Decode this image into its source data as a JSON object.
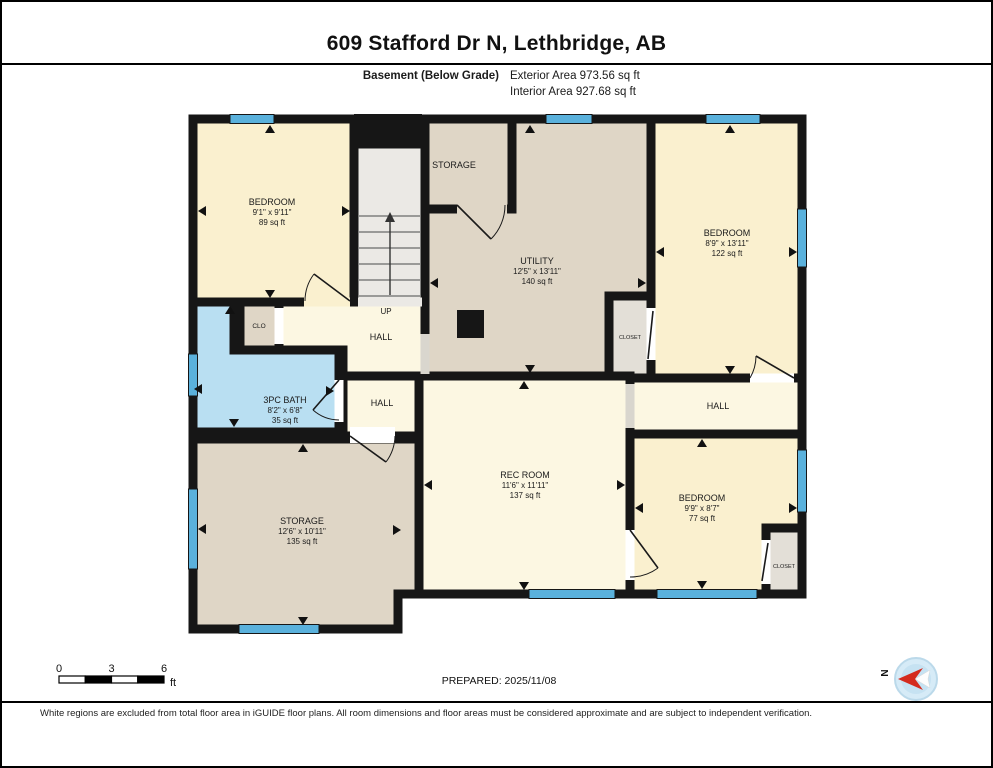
{
  "header": {
    "title": "609 Stafford Dr N, Lethbridge, AB",
    "floor_label": "Basement (Below Grade)",
    "exterior_area": "Exterior Area 973.56 sq ft",
    "interior_area": "Interior Area 927.68 sq ft"
  },
  "rooms": {
    "bedroom_top_left": {
      "name": "BEDROOM",
      "dims": "9'1\" x 9'11\"",
      "area": "89 sq ft"
    },
    "storage_top": {
      "name": "STORAGE"
    },
    "utility": {
      "name": "UTILITY",
      "dims": "12'5\" x 13'11\"",
      "area": "140 sq ft"
    },
    "bedroom_top_right": {
      "name": "BEDROOM",
      "dims": "8'9\" x 13'11\"",
      "area": "122 sq ft"
    },
    "closet_small": {
      "name": "CLO"
    },
    "stair_label": {
      "name": "UP"
    },
    "hall_center": {
      "name": "HALL"
    },
    "bath": {
      "name": "3PC BATH",
      "dims": "8'2\" x 6'8\"",
      "area": "35 sq ft"
    },
    "hall_lower": {
      "name": "HALL"
    },
    "closet_mid": {
      "name": "CLOSET"
    },
    "hall_right": {
      "name": "HALL"
    },
    "rec_room": {
      "name": "REC ROOM",
      "dims": "11'6\" x 11'11\"",
      "area": "137 sq ft"
    },
    "storage_lower": {
      "name": "STORAGE",
      "dims": "12'6\" x 10'11\"",
      "area": "135 sq ft"
    },
    "bedroom_bottom_right": {
      "name": "BEDROOM",
      "dims": "9'9\" x 8'7\"",
      "area": "77 sq ft"
    },
    "closet_bottom_right": {
      "name": "CLOSET"
    }
  },
  "scale_bar": {
    "tick_0": "0",
    "tick_3": "3",
    "tick_6": "6",
    "unit": "ft"
  },
  "compass": {
    "north_label": "N"
  },
  "footer": {
    "prepared": "PREPARED: 2025/11/08",
    "disclaimer": "White regions are excluded from total floor area in iGUIDE floor plans. All room dimensions and floor areas must be considered approximate and are subject to independent verification."
  },
  "colors": {
    "room_cream": "#FAF0CF",
    "hall_cream": "#FCF7E2",
    "utility_tan": "#DFD6C6",
    "bath_blue": "#B9DFF2",
    "stairs_grey": "#EBE9E5",
    "closet_grey": "#E3DFD7",
    "window_blue": "#5AB1DC",
    "wall_black": "#161616",
    "compass_red": "#D42B1E"
  }
}
